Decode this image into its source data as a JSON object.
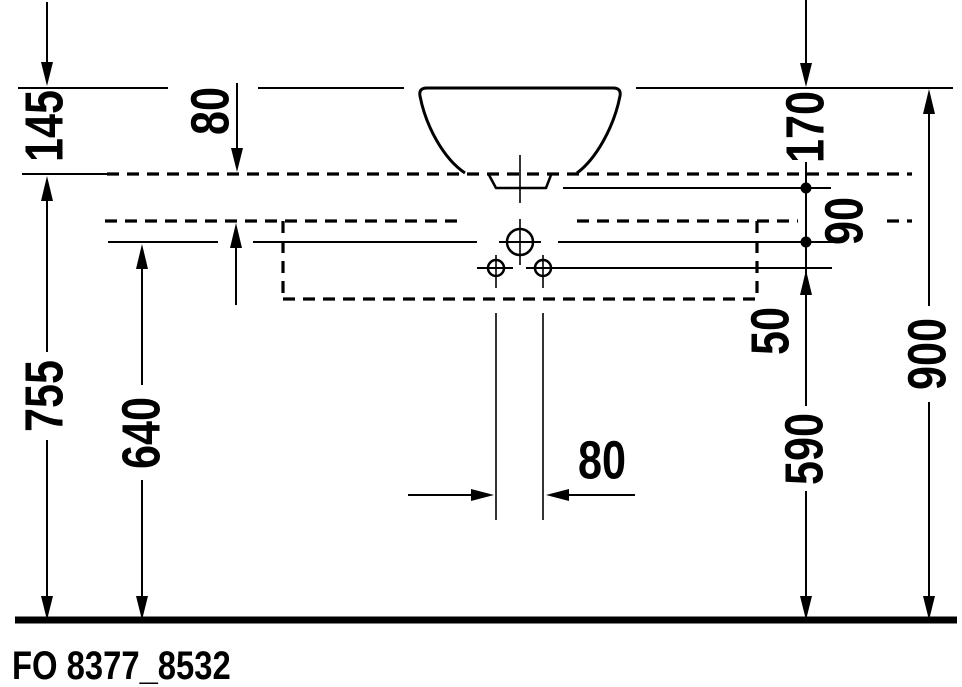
{
  "title": {
    "product_code": "FO 8377_8532"
  },
  "drawing": {
    "type": "technical-installation-drawing",
    "line_color": "#000000",
    "background": "#ffffff",
    "dimensions": {
      "basin_height": "145",
      "counter_thickness": "80",
      "rim_to_outlet": "170",
      "outlet_to_faucet_line": "90",
      "faucet_to_lower_holes": "50",
      "floor_to_counter": "755",
      "floor_to_faucet_line": "640",
      "floor_to_lower_holes": "590",
      "floor_to_rim": "900",
      "hole_spacing": "80"
    }
  }
}
